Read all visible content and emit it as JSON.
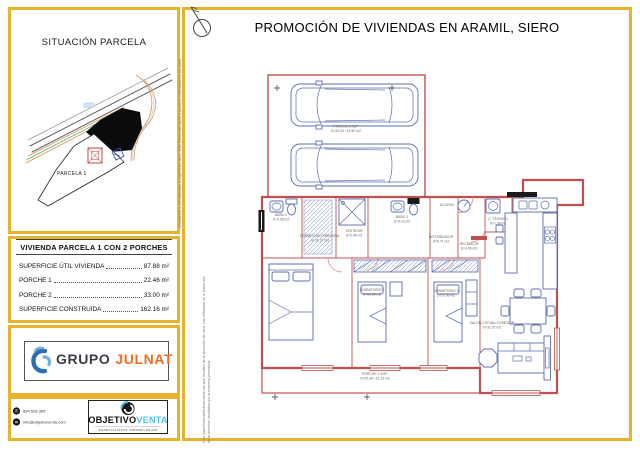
{
  "page": {
    "title": "PROMOCIÓN DE VIVIENDAS EN ARAMIL, SIERO"
  },
  "situacion": {
    "title": "SITUACIÓN PARCELA",
    "parcel_label": "PARCELA 1"
  },
  "surface_table": {
    "title": "VIVIENDA PARCELA 1 CON 2 PORCHES",
    "rows": [
      {
        "label": "SUPERFICIE ÚTIL VIVIENDA",
        "value": "87.88 m²"
      },
      {
        "label": "PORCHE 1",
        "value": "22.46 m²"
      },
      {
        "label": "PORCHE 2",
        "value": "33.00 m²"
      },
      {
        "label": "SUPERFICIE CONSTRUIDA",
        "value": "162.16 m²"
      }
    ]
  },
  "logos": {
    "grupo": "GRUPO",
    "julnat": "JULNAT",
    "objetivo": "OBJETIVO",
    "venta": "VENTA",
    "tagline": "ESPECIALISTAS INMOBILIARIOS"
  },
  "contact": {
    "phone": "684 528 365",
    "email": "info@objetivoventa.com"
  },
  "disclaimer": {
    "part1": "orientativas y corresponden a superficies útiles. Este plano está sujeto a posibles modificaciones por parte",
    "part2": "*Las superficies definitivas serán las que resulten de la ejecución de obra. Las reflejadas en el plano son",
    "part3": "de la dirección facultativa y/o la empresa promotora."
  },
  "plan": {
    "porche2": {
      "name": "PORCHE 2 SUP.",
      "size": "S=33.00 / 16.50 m2"
    },
    "porche1": {
      "name": "PORCHE 1 SUP.",
      "size": "S=22.46 / 11.23 m2"
    },
    "rooms": [
      {
        "name": "BAÑO 2",
        "size": "S=4.35 m2"
      },
      {
        "name": "VESTIDOR",
        "size": "S=5.05 m2"
      },
      {
        "name": "BAÑO 1",
        "size": "S=5.12 m2"
      },
      {
        "name": "DISTRIBUIDOR",
        "size": "S=5.71 m2"
      },
      {
        "name": "RECIBIDOR",
        "size": "S=4.96 m2"
      },
      {
        "name": "ACCESO",
        "size": ""
      },
      {
        "name": "C. TÉCNICO",
        "size": "S=1.34 m2"
      },
      {
        "name": "DORMITORIO PRINCIPAL",
        "size": "S=16.27 m2"
      },
      {
        "name": "DORMITORIO 2",
        "size": "S=10.98 m2"
      },
      {
        "name": "DORMITORIO 3",
        "size": "S=10.98 m2"
      },
      {
        "name": "SALON-COCINA-COMEDOR",
        "size": "S=32.37 m2"
      }
    ]
  },
  "colors": {
    "frame_gold": "#e6b42c",
    "plan_red": "#c0504d",
    "furniture_blue": "#5b6cb0",
    "julnat_orange": "#f26a21",
    "venta_blue": "#4fc3e8"
  }
}
